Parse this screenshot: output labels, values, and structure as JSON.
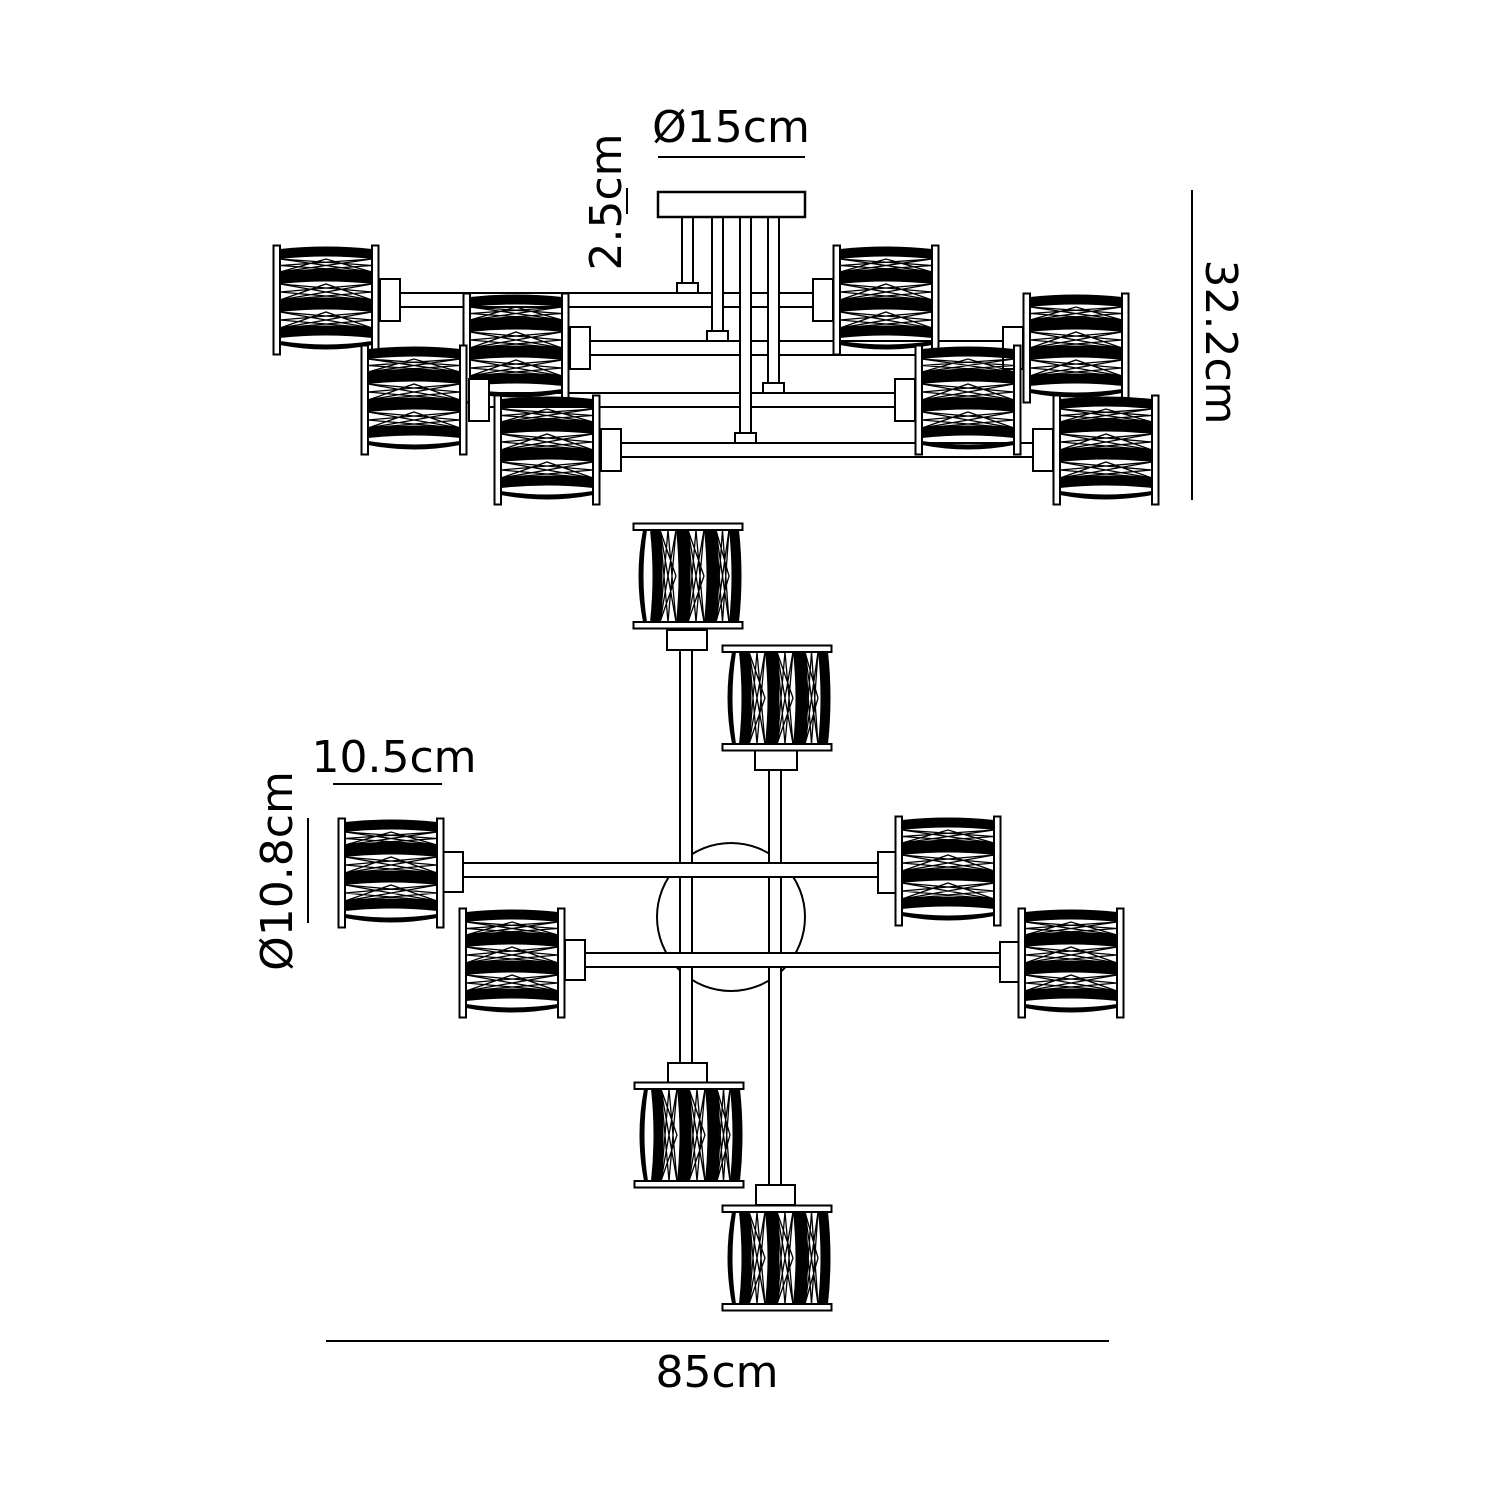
{
  "page": {
    "background": "#ffffff",
    "line_color": "#000000"
  },
  "diagram": {
    "subject": "crystal drum chandelier dimension drawing",
    "views": {
      "elevation": {
        "shade_count": 8,
        "arm_levels": 4,
        "drop_rods": 4
      },
      "plan": {
        "shade_count": 8,
        "arm_tubes": 4,
        "canopy_circle": 1
      }
    },
    "dims": {
      "canopy_diameter": "Ø15cm",
      "canopy_thickness": "2.5cm",
      "fixture_height": "32.2cm",
      "shade_width": "10.5cm",
      "shade_diameter": "Ø10.8cm",
      "fixture_width": "85cm"
    }
  }
}
